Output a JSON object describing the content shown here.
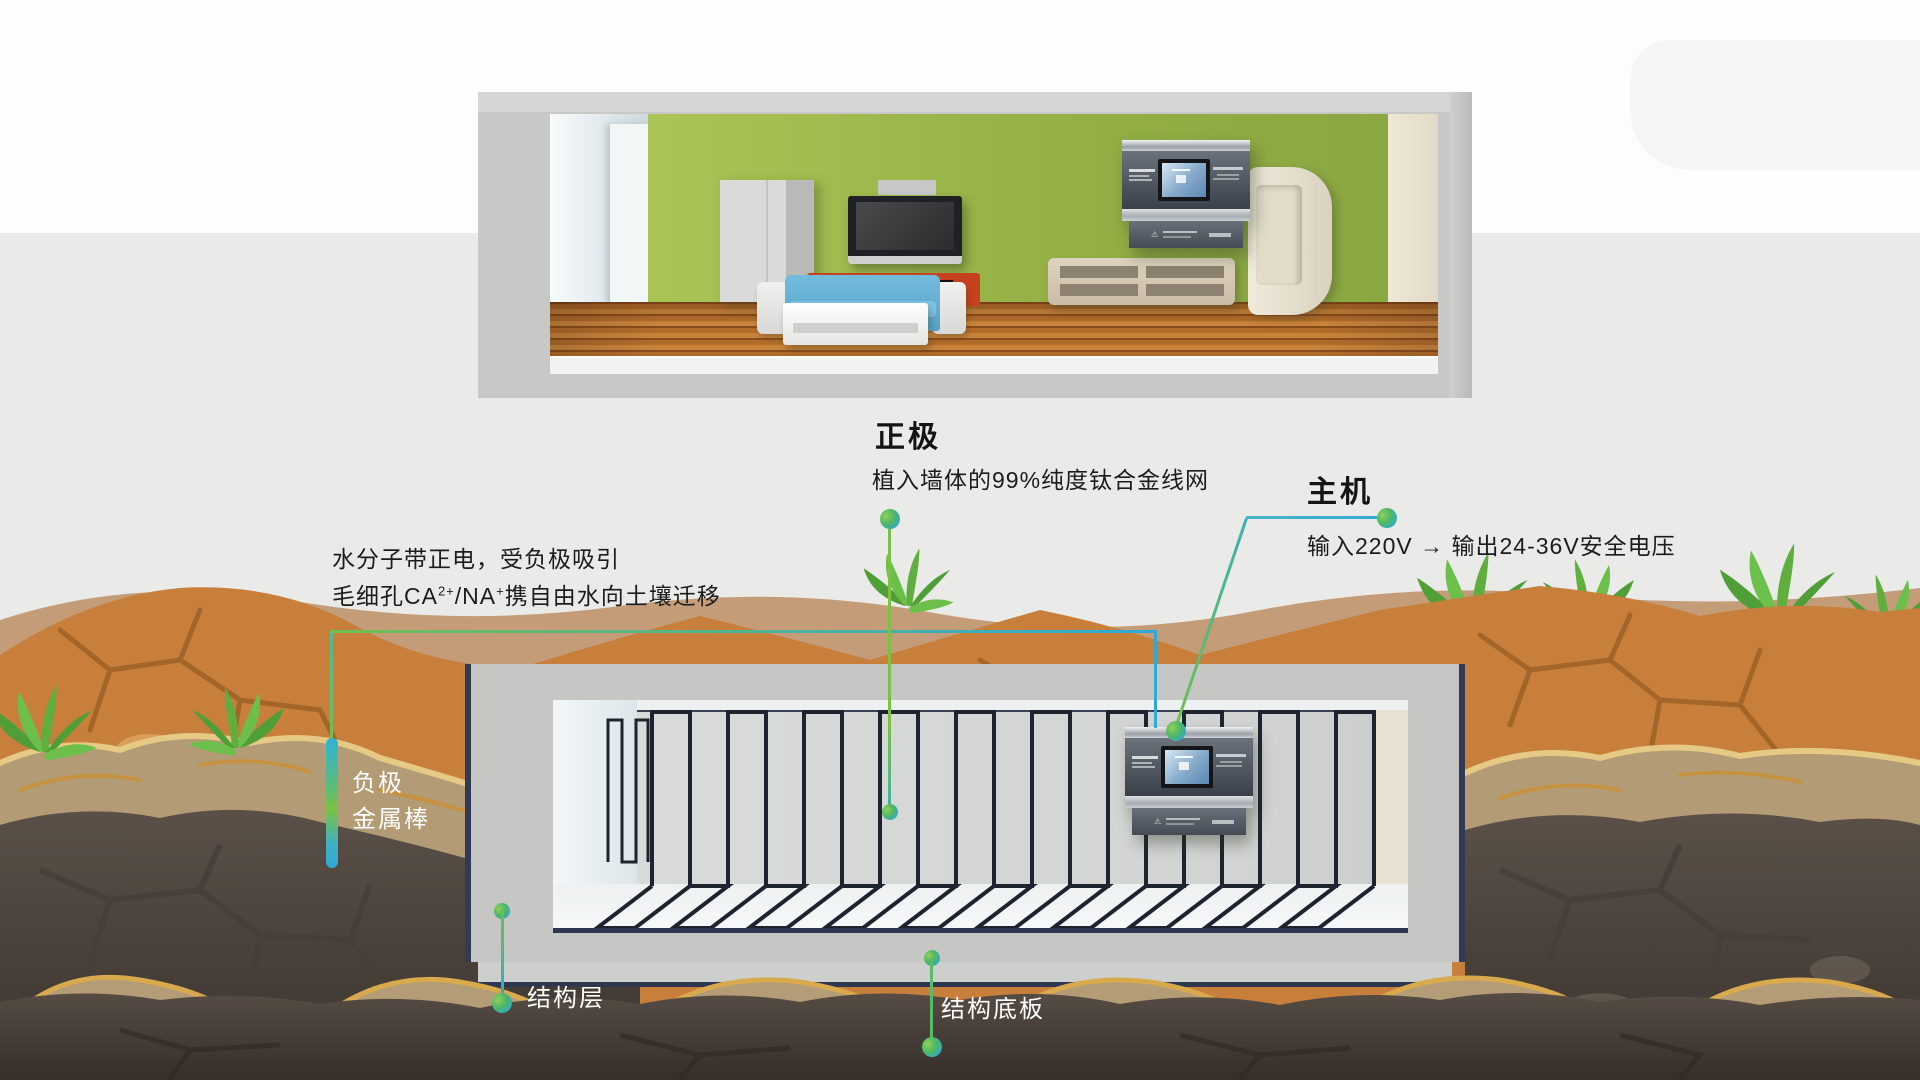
{
  "diagram": {
    "positive": {
      "title": "正极",
      "desc": "植入墙体的99%纯度钛合金线网"
    },
    "host": {
      "title": "主机",
      "desc": "输入220V → 输出24-36V安全电压"
    },
    "migration": {
      "line1": "水分子带正电，受负极吸引",
      "line2_a": "毛细孔CA",
      "line2_sup1": "2+",
      "line2_b": "/NA",
      "line2_sup2": "+",
      "line2_c": "携自由水向土壤迁移"
    },
    "negative": {
      "line1": "负极",
      "line2": "金属棒"
    },
    "structure_layer": "结构层",
    "structure_base": "结构底板"
  },
  "colors": {
    "accent_green": "#7cc142",
    "accent_blue": "#2ea9d8",
    "wall_green": "#9cb74d",
    "sofa_blue": "#64aed3",
    "soil_orange": "#c77f3b",
    "soil_dark": "#564c44",
    "wire_navy": "#1d2430"
  }
}
